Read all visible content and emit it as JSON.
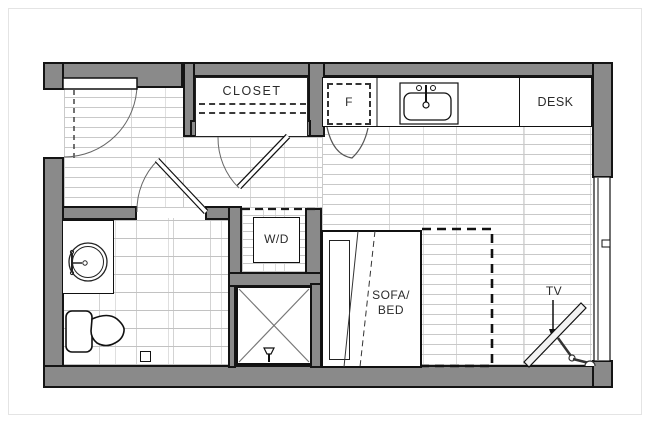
{
  "floor_plan": {
    "title": "Studio apartment floor plan",
    "labels": {
      "closet": "CLOSET",
      "fridge": "F",
      "desk": "DESK",
      "washer_dryer": "W/D",
      "sofa_bed_line1": "SOFA/",
      "sofa_bed_line2": "BED",
      "tv": "TV"
    },
    "fixtures": [
      "entry-door",
      "closet",
      "refrigerator",
      "kitchen-sink",
      "kitchen-counter",
      "desk",
      "washer-dryer",
      "bathroom-vanity-sink",
      "toilet",
      "shower",
      "sofa-bed",
      "fold-out-bed-outline",
      "tv",
      "window"
    ],
    "colors": {
      "wall": "#8a8a8a",
      "outline": "#141414",
      "floor_line": "#c9c9c9",
      "background": "#ffffff"
    }
  }
}
